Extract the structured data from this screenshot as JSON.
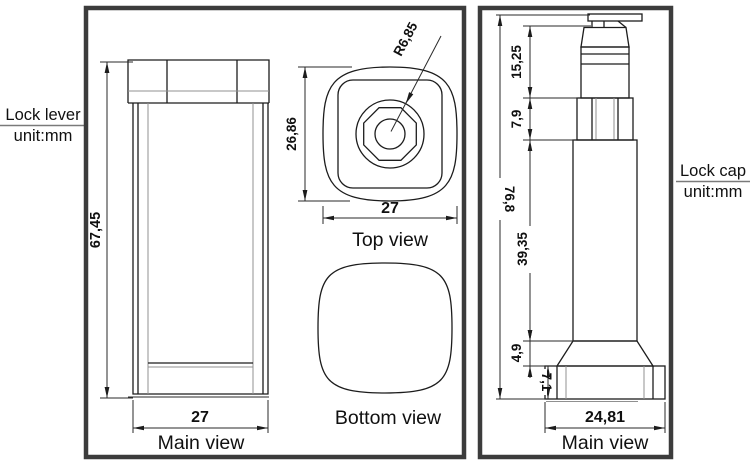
{
  "colors": {
    "line": "#1c1c1c",
    "panel_border": "#3c3c3c",
    "gray_line": "#909090",
    "background": "#ffffff",
    "text": "#101010"
  },
  "left_panel": {
    "callout": {
      "line1": "Lock lever",
      "line2": "unit:mm"
    },
    "main_view": {
      "label": "Main view",
      "height": "67,45",
      "width": "27"
    },
    "top_view": {
      "label": "Top view",
      "radius": "R6,85",
      "height": "26,86",
      "width": "27"
    },
    "bottom_view": {
      "label": "Bottom view"
    }
  },
  "right_panel": {
    "callout": {
      "line1": "Lock cap",
      "line2": "unit:mm"
    },
    "main_view": {
      "label": "Main view",
      "overall_height": "76,8",
      "top_section_height": "15,25",
      "collar_height": "7,9",
      "body_height": "39,35",
      "flare_height": "4,9",
      "base_height": "7,1",
      "base_width": "24,81"
    }
  }
}
